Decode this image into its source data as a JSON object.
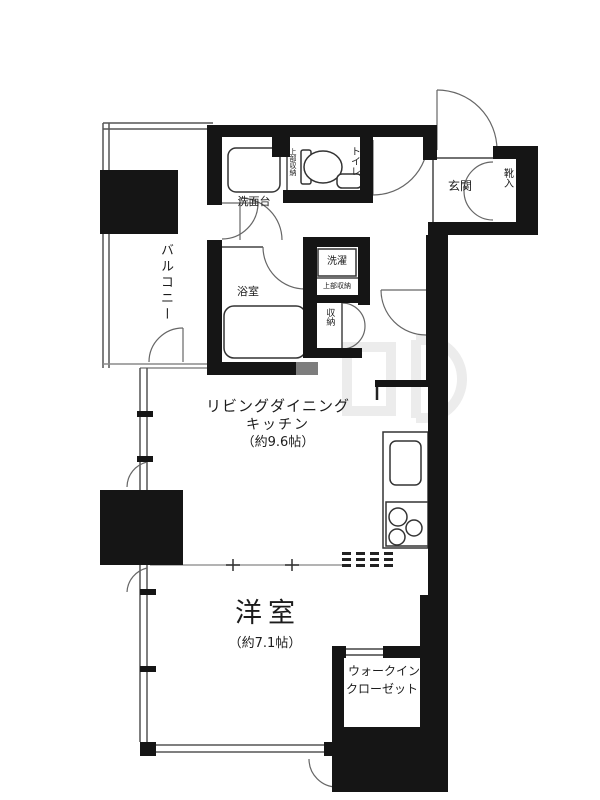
{
  "floorplan": {
    "balcony_label": "バルコニー",
    "washstand_label": "洗面台",
    "toilet_label": "トイレ",
    "toilet_storage_label": "上部収納",
    "entrance_label": "玄関",
    "shoe_cabinet_label": "靴入",
    "bathroom_label": "浴室",
    "laundry_label": "洗濯",
    "laundry_storage_label": "上部収納",
    "storage_label": "収納",
    "ldk_label_line1": "リビングダイニング",
    "ldk_label_line2": "キッチン",
    "ldk_size": "（約9.6帖）",
    "bedroom_label": "洋室",
    "bedroom_size": "（約7.1帖）",
    "wic_label_line1": "ウォークイン",
    "wic_label_line2": "クローゼット"
  },
  "colors": {
    "wall": "#151515",
    "line": "#555555",
    "background": "#ffffff"
  }
}
